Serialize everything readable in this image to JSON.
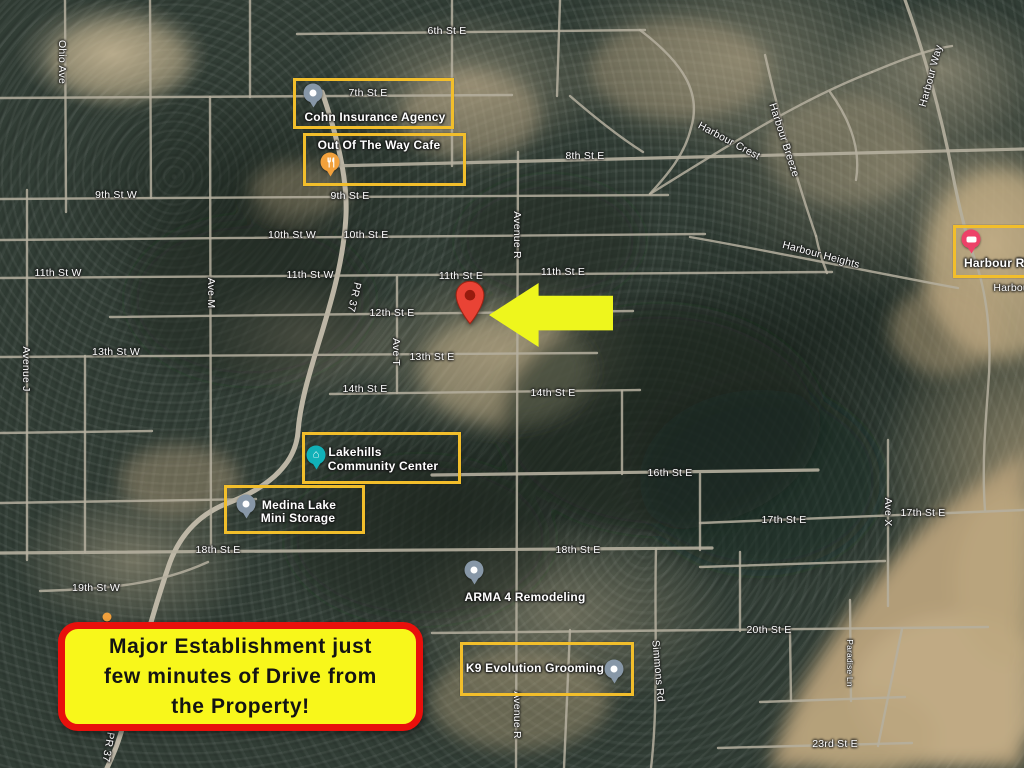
{
  "colors": {
    "highlight_box": "#F2BE2B",
    "arrow": "#EEF61D",
    "callout_bg": "#F8F71B",
    "callout_border": "#E8100C",
    "property_pin": "#E94335",
    "road": "#B5AF9F",
    "label_text": "#FFFFFF"
  },
  "annotations": {
    "callout": {
      "line1": "Major Establishment just",
      "line2": "few minutes of Drive from",
      "line3": "the Property!"
    },
    "arrow_direction": "left",
    "property_marker": "red-map-pin"
  },
  "pois": [
    {
      "name": "Cohn Insurance Agency",
      "lines": [
        "Cohn Insurance Agency"
      ],
      "icon": "generic-place",
      "pin_color": "#8797A7",
      "highlighted": true
    },
    {
      "name": "Out Of The Way Cafe",
      "lines": [
        "Out Of The Way Cafe"
      ],
      "icon": "restaurant",
      "pin_color": "#F2A13C",
      "highlighted": true
    },
    {
      "name": "Lakehills Community Center",
      "lines": [
        "Lakehills",
        "Community Center"
      ],
      "icon": "community-center",
      "pin_color": "#11B1B8",
      "highlighted": true
    },
    {
      "name": "Medina Lake Mini Storage",
      "lines": [
        "Medina Lake",
        "Mini Storage"
      ],
      "icon": "generic-place",
      "pin_color": "#8797A7",
      "highlighted": true
    },
    {
      "name": "ARMA 4 Remodeling",
      "lines": [
        "ARMA 4 Remodeling"
      ],
      "icon": "generic-place",
      "pin_color": "#8797A7",
      "highlighted": false
    },
    {
      "name": "K9 Evolution Grooming",
      "lines": [
        "K9 Evolution Grooming"
      ],
      "icon": "generic-place",
      "pin_color": "#8797A7",
      "highlighted": true
    },
    {
      "name": "Harbour RV",
      "lines": [
        "Harbour RV"
      ],
      "icon": "rv-park",
      "pin_color": "#ED4168",
      "highlighted": true
    }
  ],
  "streets": [
    "6th St E",
    "7th St E",
    "8th St E",
    "9th St W",
    "9th St E",
    "10th St W",
    "10th St E",
    "11th St W",
    "11th St W",
    "11th St E",
    "11th St E",
    "12th St E",
    "13th St W",
    "13th St E",
    "14th St E",
    "14th St E",
    "16th St E",
    "17th St E",
    "17th St E",
    "18th St E",
    "18th St E",
    "19th St W",
    "20th St E",
    "23rd St E",
    "Ohio Ave",
    "Avenue J",
    "Ave M",
    "PR 37",
    "PR 37",
    "Ave T",
    "Avenue R",
    "Avenue R",
    "Simmons Rd",
    "Ave X",
    "Harbour Way",
    "Harbour Crest",
    "Harbour Breeze",
    "Harbour Heights",
    "Paradise Ln",
    "Harbour"
  ]
}
